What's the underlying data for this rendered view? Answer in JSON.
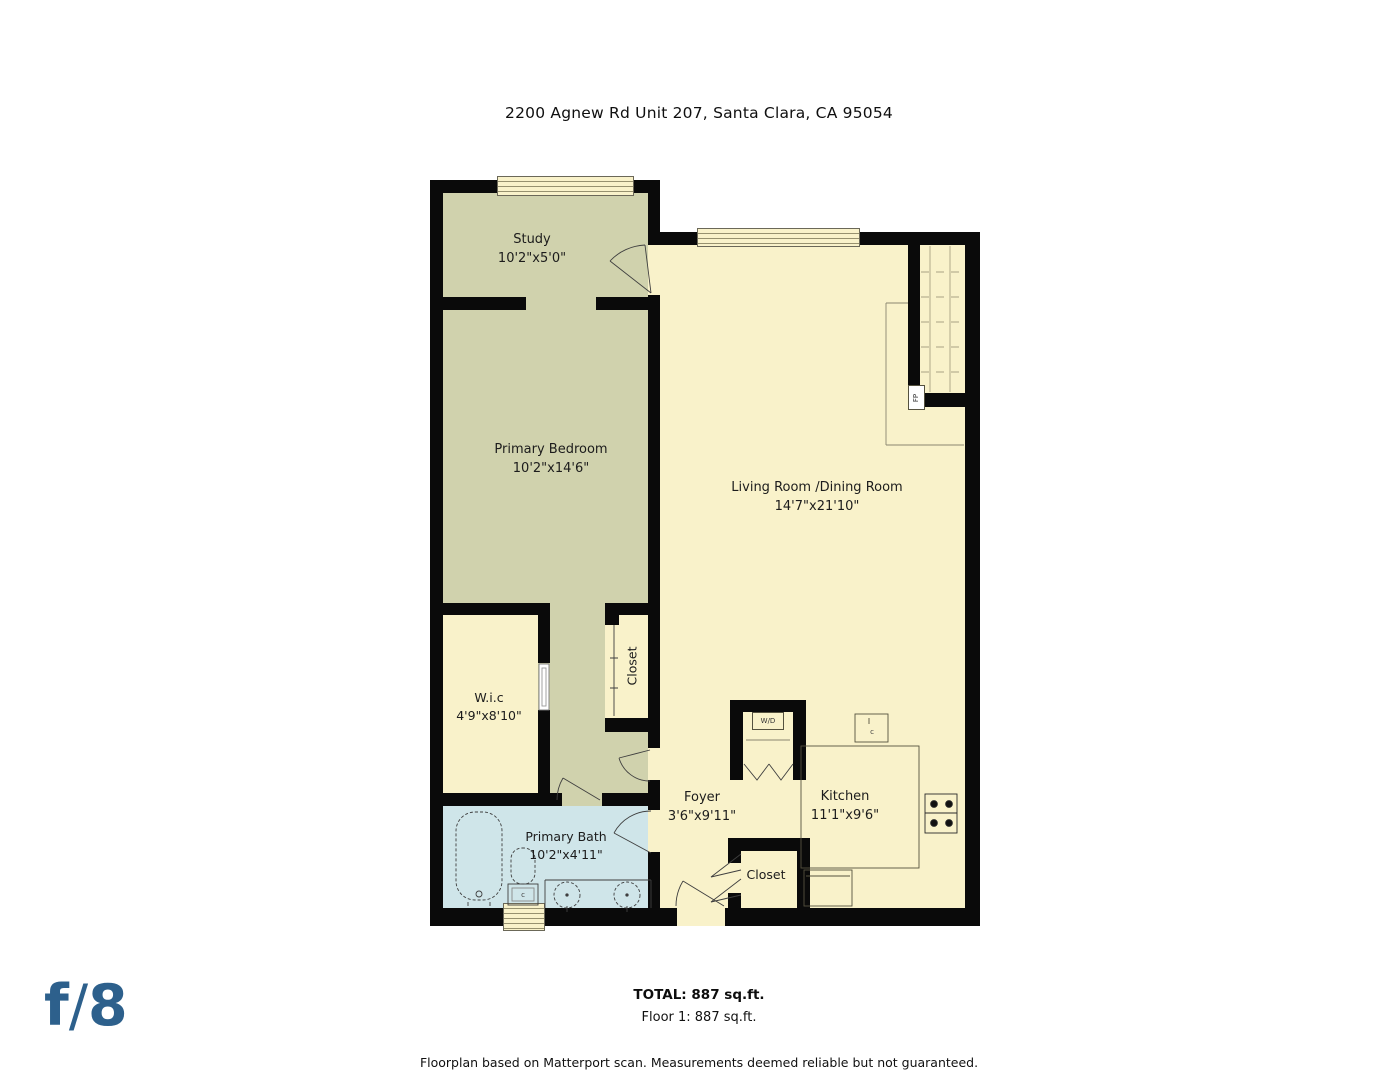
{
  "header": {
    "title": "2200 Agnew Rd Unit 207, Santa Clara, CA 95054"
  },
  "rooms": {
    "study": {
      "name": "Study",
      "dims": "10'2\"x5'0\""
    },
    "primary_bedroom": {
      "name": "Primary Bedroom",
      "dims": "10'2\"x14'6\""
    },
    "living_dining": {
      "name": "Living Room /Dining Room",
      "dims": "14'7\"x21'10\""
    },
    "wic": {
      "name": "W.i.c",
      "dims": "4'9\"x8'10\""
    },
    "hall_closet": {
      "name": "Closet"
    },
    "foyer": {
      "name": "Foyer",
      "dims": "3'6\"x9'11\""
    },
    "kitchen": {
      "name": "Kitchen",
      "dims": "11'1\"x9'6\""
    },
    "primary_bath": {
      "name": "Primary Bath",
      "dims": "10'2\"x4'11\""
    },
    "entry_closet": {
      "name": "Closet"
    }
  },
  "fixtures": {
    "washer_dryer": "W/D",
    "fireplace": "FP",
    "code_toilet": "c",
    "code_sink": "c"
  },
  "footer": {
    "total": "TOTAL: 887 sq.ft.",
    "floor": "Floor 1: 887 sq.ft.",
    "disclaimer": "Floorplan based on Matterport scan. Measurements deemed reliable but not guaranteed."
  },
  "logo": {
    "f": "f",
    "slash": "/",
    "eight": "8",
    "color": "#2d608c"
  },
  "palette": {
    "wall": "#0a0a0a",
    "room_green": "#d0d2ad",
    "room_cream": "#f9f2ca",
    "room_bath": "#cfe5e9",
    "linework": "#3f3f3f"
  }
}
